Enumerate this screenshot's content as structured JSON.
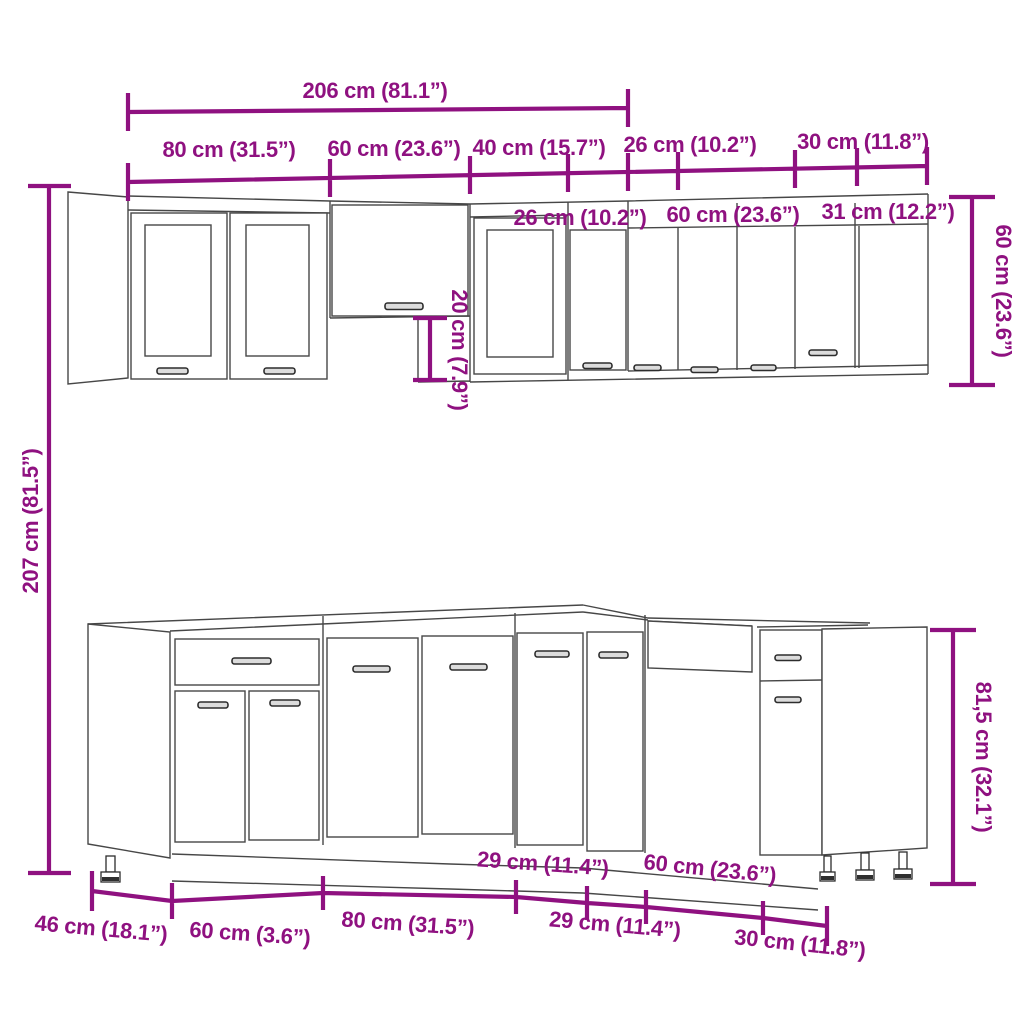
{
  "title": "Kitchen cabinet set dimension diagram",
  "colors": {
    "dimension_accent": "#8F1180",
    "line_art": "#474747",
    "background": "#FFFFFF"
  },
  "dims": {
    "top_total": "206 cm (81.1”)",
    "wall_top_widths": [
      "80 cm (31.5”)",
      "60 cm (23.6”)",
      "40 cm (15.7”)",
      "26 cm (10.2”)",
      "30 cm (11.8”)"
    ],
    "wall_right_widths": [
      "26 cm (10.2”)",
      "60 cm (23.6”)",
      "31 cm (12.2”)"
    ],
    "wall_cabinet_height": "60 cm (23.6”)",
    "hood_gap_height": "20 cm (7.9”)",
    "total_height": "207 cm (81.5”)",
    "base_depth": "46 cm (18.1”)",
    "base_widths_below": [
      "60 cm (3.6”)",
      "80 cm (31.5”)",
      "29 cm (11.4”)",
      "30 cm (11.8”)"
    ],
    "base_widths_above": [
      "29 cm (11.4”)",
      "60 cm (23.6”)"
    ],
    "base_height": "81,5 cm (32.1”)"
  }
}
